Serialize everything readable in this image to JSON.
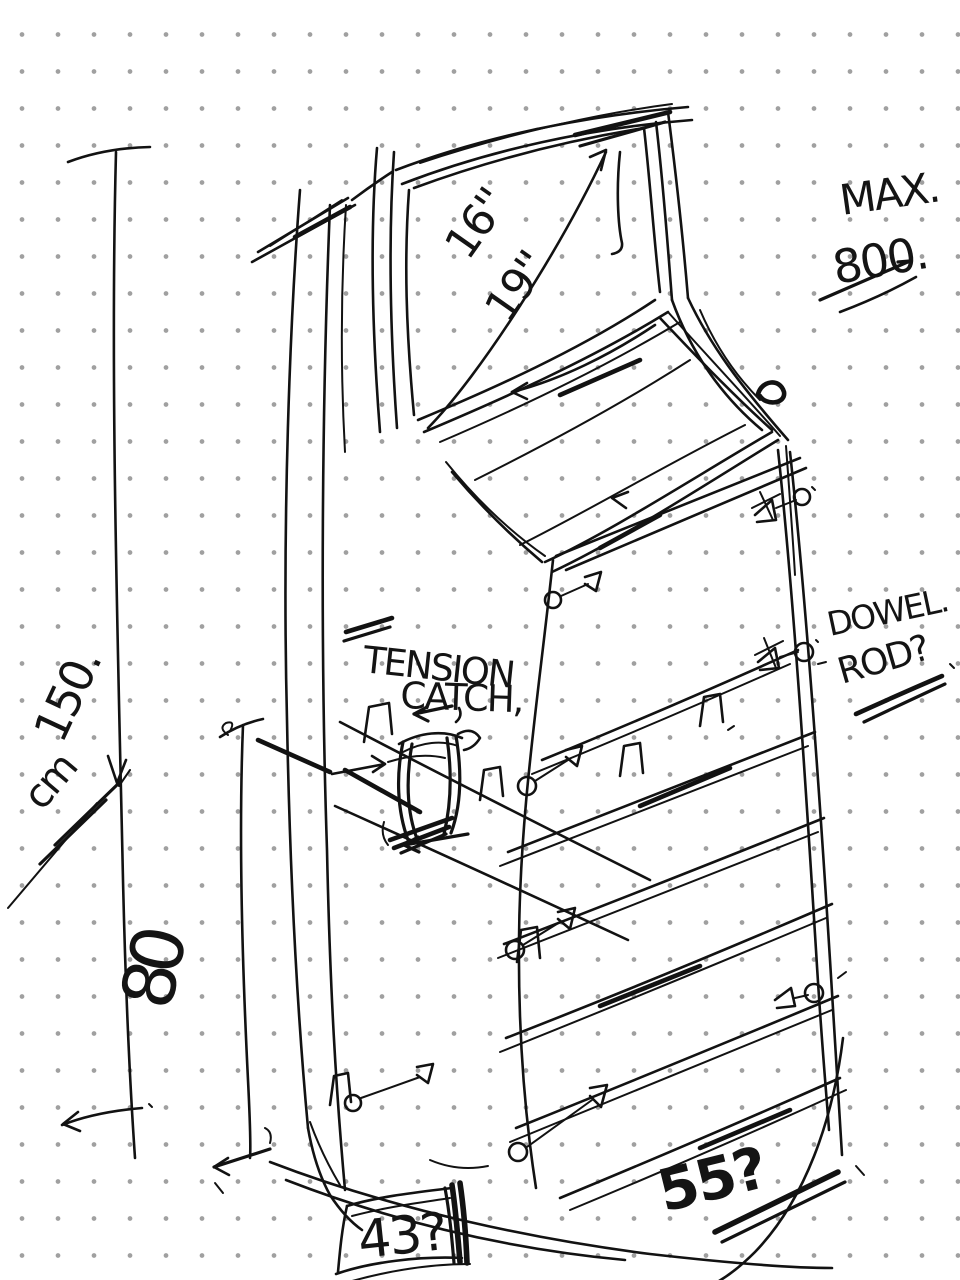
{
  "canvas": {
    "background": "#ffffff",
    "dot_color": "#a0a0a0",
    "ink_color": "#121212"
  },
  "annotations": {
    "screen": {
      "diagonal_primary": "16''",
      "diagonal_secondary": "19''"
    },
    "max_note": {
      "label": "MAX.",
      "value": "800."
    },
    "overall_height": {
      "value": "150.",
      "unit": "cm"
    },
    "mid_height": "80",
    "tension_catch": {
      "line1": "TENSION",
      "line2": "CATCH,"
    },
    "dowel_note": {
      "line1": "DOWEL.",
      "line2": "ROD?"
    },
    "base_width": "43?",
    "depth": "55?"
  }
}
